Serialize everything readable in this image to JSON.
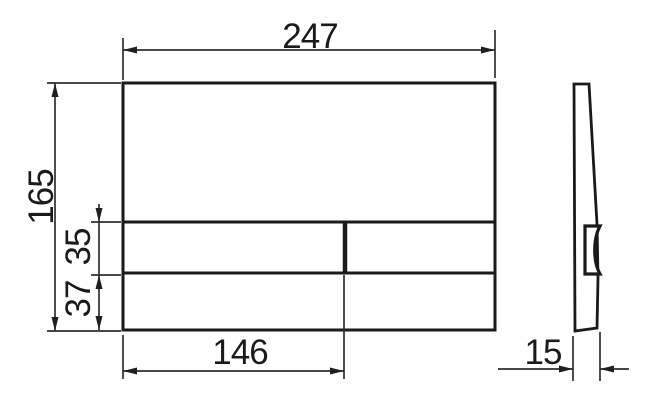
{
  "diagram": {
    "type": "technical-dimension-drawing",
    "subject": "rectangular flush plate with two buttons, front view and side profile view",
    "background_color": "#ffffff",
    "line_color": "#1a1a1a",
    "dimensions": {
      "plate_width": "247",
      "plate_height": "165",
      "button_row_height": "35",
      "bottom_band_height": "37",
      "large_button_width": "146",
      "plate_thickness": "15"
    }
  }
}
